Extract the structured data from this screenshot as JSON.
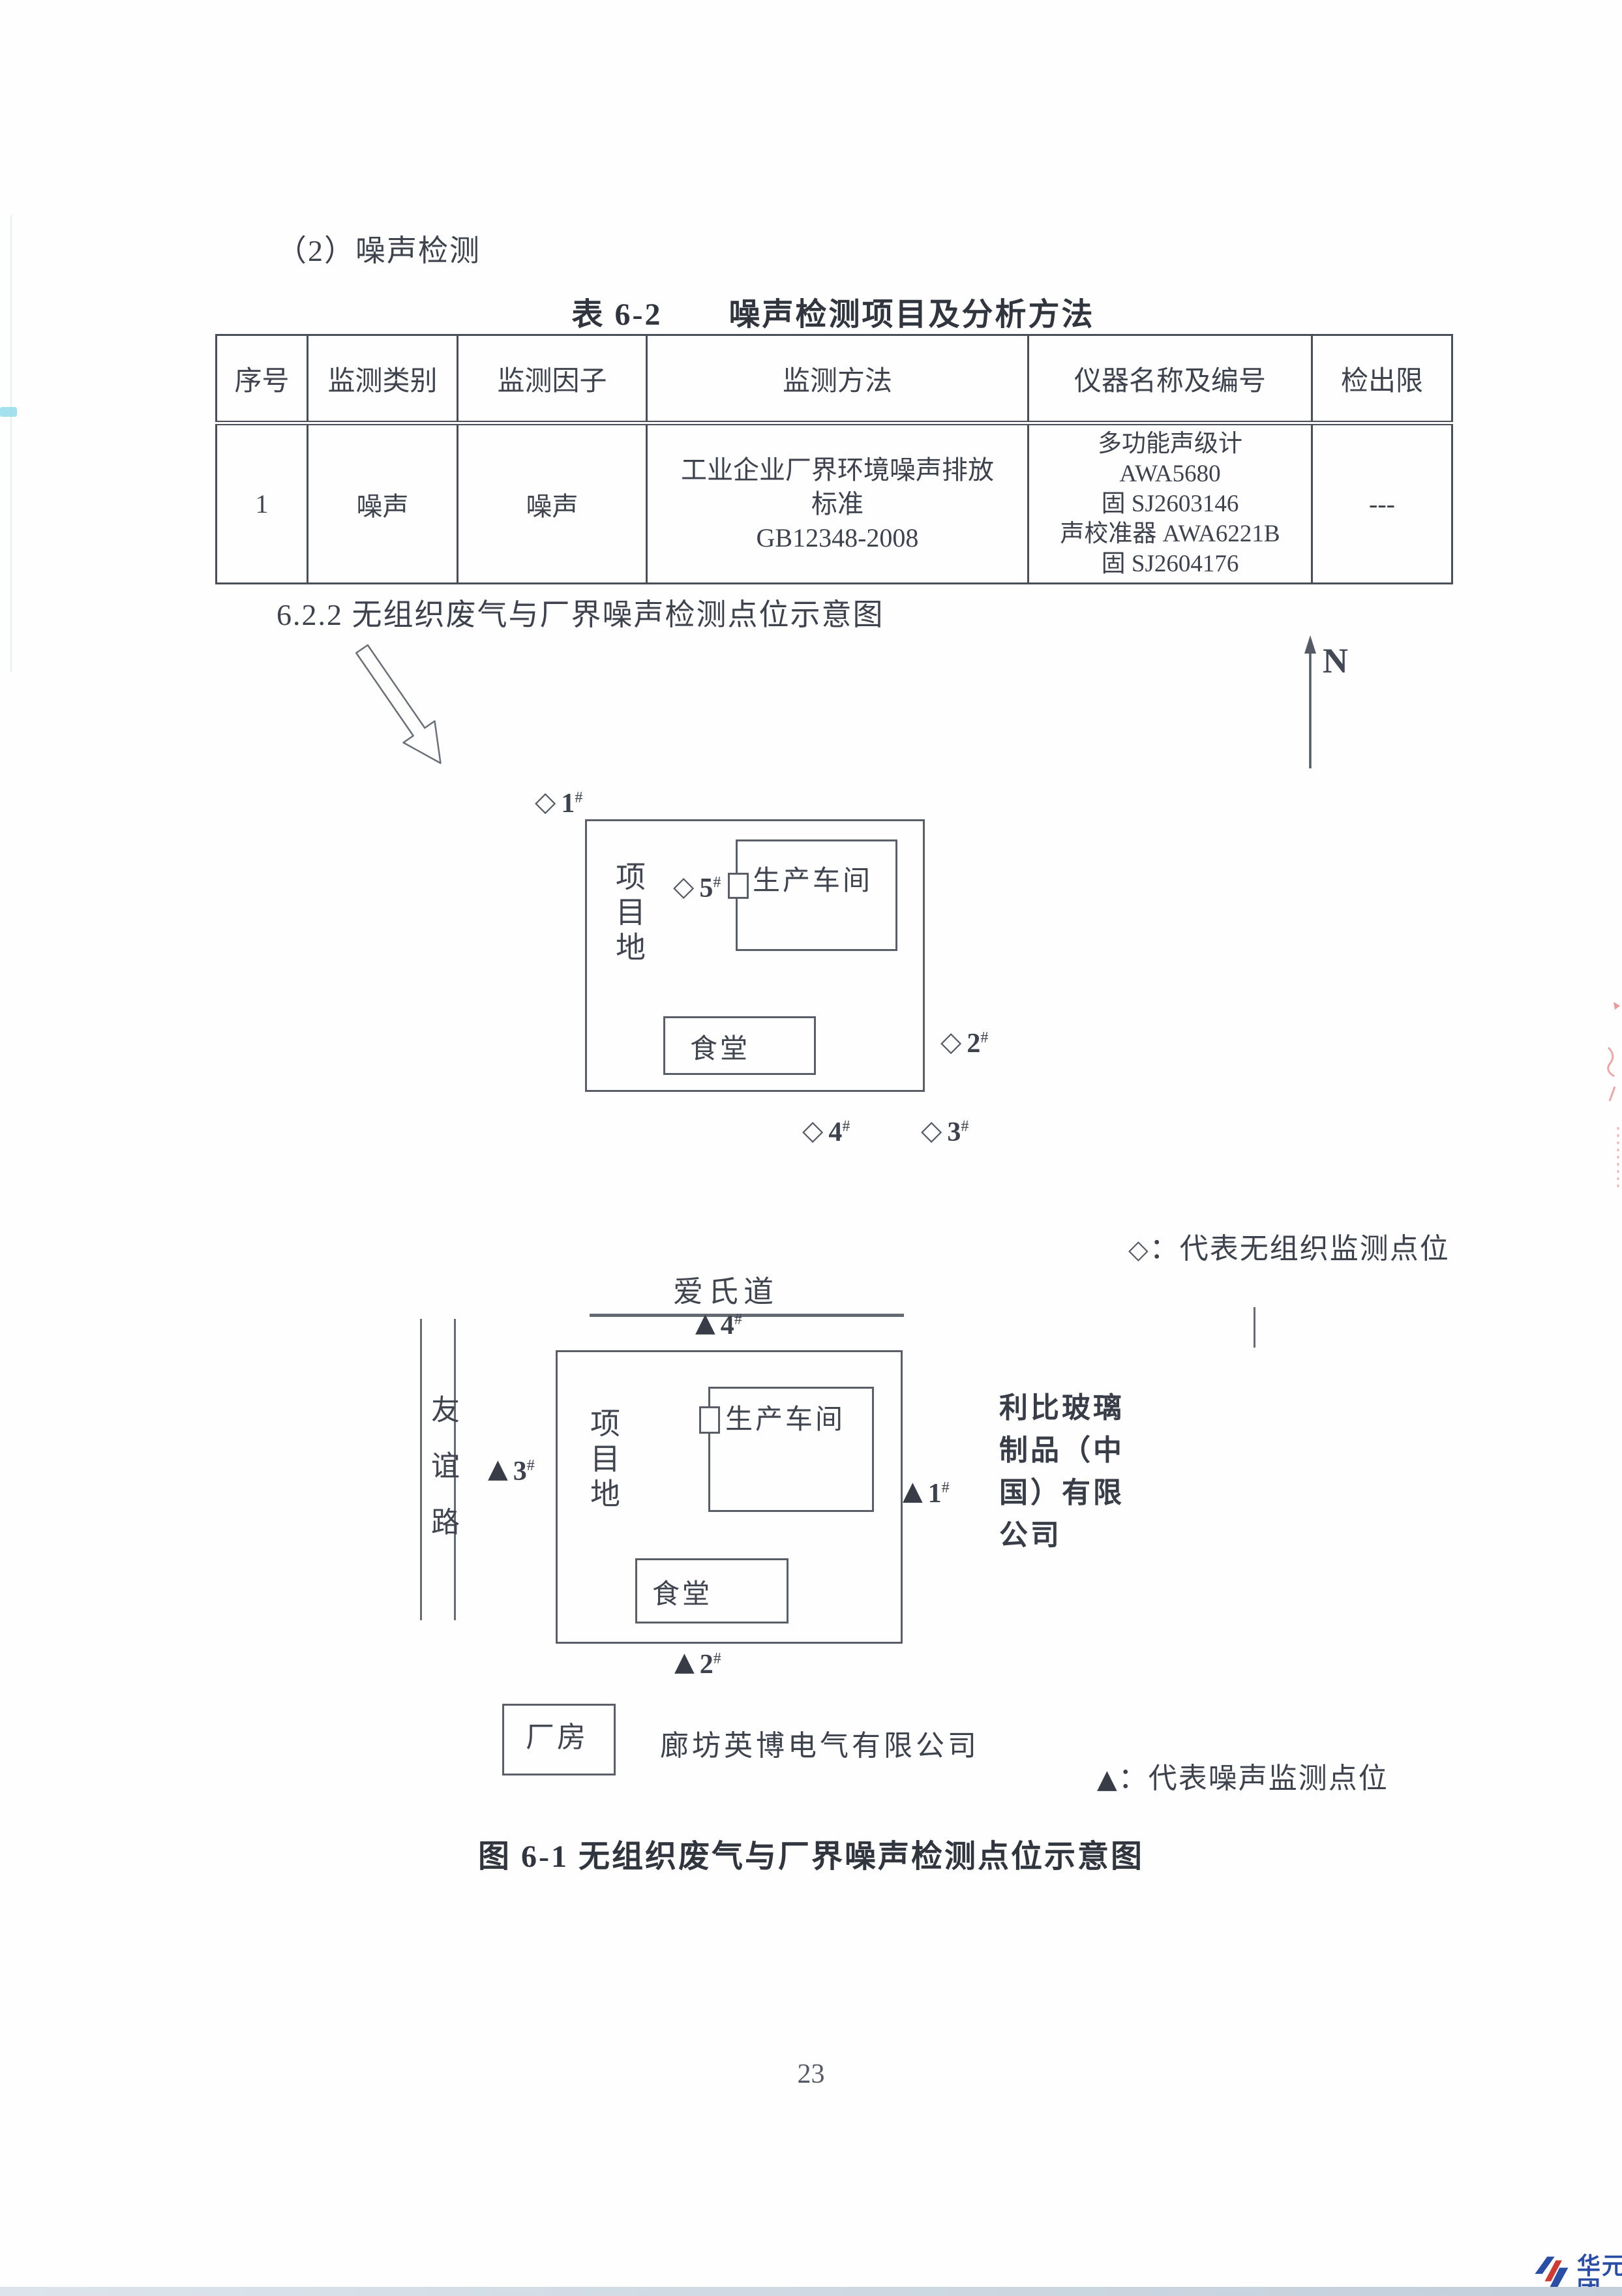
{
  "page": {
    "number": "23"
  },
  "heading": {
    "noise_section": "（2）噪声检测",
    "subsection": "6.2.2 无组织废气与厂界噪声检测点位示意图",
    "figure_caption": "图 6-1 无组织废气与厂界噪声检测点位示意图"
  },
  "table": {
    "title": "表 6-2　　噪声检测项目及分析方法",
    "headers": [
      "序号",
      "监测类别",
      "监测因子",
      "监测方法",
      "仪器名称及编号",
      "检出限"
    ],
    "row": {
      "index": "1",
      "category": "噪声",
      "factor": "噪声",
      "method": "工业企业厂界环境噪声排放\n标准\nGB12348-2008",
      "instrument": "多功能声级计\nAWA5680\n固 SJ2603146\n声校准器 AWA6221B\n固 SJ2604176",
      "detection_limit": "---"
    }
  },
  "compass": {
    "label": "N"
  },
  "symbols": {
    "diamond": "◇",
    "triangle": "▲"
  },
  "marker_suffix": "#",
  "diagram1": {
    "site_label": "项目地",
    "workshop_label": "生产车间",
    "canteen_label": "食堂",
    "points": {
      "p1": "1",
      "p2": "2",
      "p3": "3",
      "p4": "4",
      "p5": "5"
    },
    "legend": "：代表无组织监测点位"
  },
  "diagram2": {
    "road_top": "爱氏道",
    "road_left": "友谊路",
    "site_label": "项目地",
    "workshop_label": "生产车间",
    "canteen_label": "食堂",
    "points": {
      "p1": "1",
      "p2": "2",
      "p3": "3",
      "p4": "4"
    },
    "neighbor_right": "利比玻璃制品（中国）有限公司",
    "factory_box": "厂房",
    "neighbor_bottom": "廊坊英博电气有限公司",
    "legend": "：代表噪声监测点位"
  },
  "watermark": {
    "cn": "华元集团",
    "en": "HUAYUAN"
  }
}
